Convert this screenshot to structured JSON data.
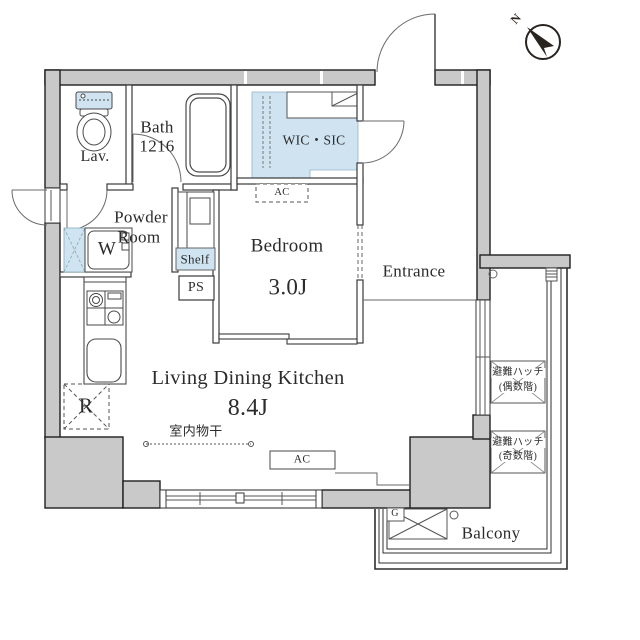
{
  "plan": {
    "compass": {
      "north_label": "N"
    },
    "rooms": {
      "lav": {
        "label": "Lav."
      },
      "bath": {
        "label": "Bath",
        "size": "1216"
      },
      "powder": {
        "line1": "Powder",
        "line2": "Room"
      },
      "wic": {
        "label": "WIC・SIC"
      },
      "bedroom": {
        "label": "Bedroom",
        "size": "3.0J"
      },
      "entrance": {
        "label": "Entrance"
      },
      "ldk": {
        "label": "Living Dining Kitchen",
        "size": "8.4J"
      },
      "balcony": {
        "label": "Balcony"
      }
    },
    "fixtures": {
      "washing_machine": "W",
      "shelf": "Shelf",
      "pipe_space": "PS",
      "ac_bedroom": "AC",
      "ac_ldk": "AC",
      "refrigerator": "R",
      "indoor_drying": "室内物干",
      "water_heater": "G",
      "hatch_even_line1": "避難ハッチ",
      "hatch_even_line2": "(偶数階)",
      "hatch_odd_line1": "避難ハッチ",
      "hatch_odd_line2": "(奇数階)"
    },
    "colors": {
      "wall_fill": "#c9c9c9",
      "closet_fill": "#cfe3f1",
      "line": "#2b2b2b"
    }
  }
}
